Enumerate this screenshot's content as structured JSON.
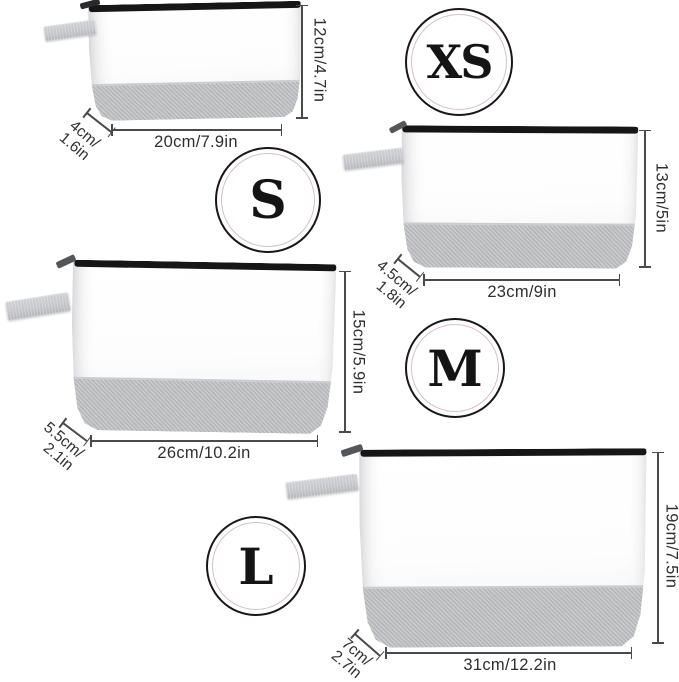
{
  "diagram": {
    "bags": [
      {
        "size": "XS",
        "height": "12cm/4.7in",
        "width": "20cm/7.9in",
        "depth_line1": "4cm/",
        "depth_line2": "1.6in"
      },
      {
        "size": "S",
        "height": "13cm/5in",
        "width": "23cm/9in",
        "depth_line1": "4.5cm/",
        "depth_line2": "1.8in"
      },
      {
        "size": "M",
        "height": "15cm/5.9in",
        "width": "26cm/10.2in",
        "depth_line1": "5.5cm/",
        "depth_line2": "2.1in"
      },
      {
        "size": "L",
        "height": "19cm/7.5in",
        "width": "31cm/12.2in",
        "depth_line1": "7cm/",
        "depth_line2": "2.7in"
      }
    ],
    "colors": {
      "background": "#ffffff",
      "bag_body": "#fcfcfd",
      "fabric_band": "#bcbdc0",
      "handle": "#c5c6ca",
      "zipper": "#161616",
      "dimension_line": "#4a4a4a",
      "dimension_text": "#2f2f2f",
      "badge_outer_ring": "#18181a",
      "badge_inner_ring": "#d6bfd0",
      "badge_text": "#141414"
    }
  }
}
